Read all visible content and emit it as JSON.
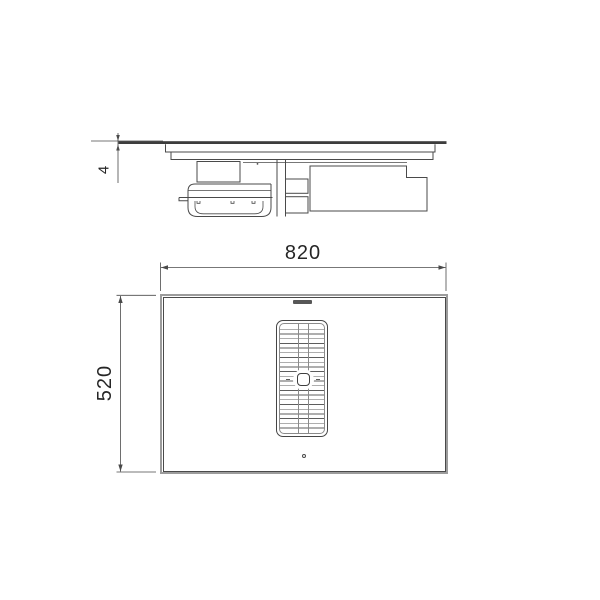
{
  "drawing": {
    "type": "technical-dimension-drawing",
    "subject": "induction-hob-with-central-downdraft-extractor",
    "views": {
      "side_profile": {
        "parts": [
          "glass-top",
          "worktop-line",
          "hob-body",
          "junction-box",
          "filter-drawer",
          "air-duct",
          "motor-housing"
        ]
      },
      "top_plan": {
        "parts": [
          "cooktop-surface",
          "left-cooking-zone-lines",
          "right-cooking-zone-lines",
          "central-extractor-grille",
          "grille-center-knob",
          "brand-logo",
          "power-indicator-dot"
        ]
      }
    },
    "dimensions": {
      "width": {
        "value": "820",
        "unit_implied": "mm",
        "orientation": "horizontal"
      },
      "depth": {
        "value": "520",
        "unit_implied": "mm",
        "orientation": "vertical"
      },
      "glass_thickness": {
        "value": "4",
        "unit_implied": "mm",
        "orientation": "vertical"
      }
    },
    "icons": {
      "brand_logo": "brand-logo-smudge",
      "power_indicator": "power-dot"
    },
    "colors": {
      "background": "#ffffff",
      "line": "#4a4a4a",
      "glass_band": "#3d3d3d",
      "frame_gray": "#9c9c9c",
      "text": "#262626"
    }
  }
}
